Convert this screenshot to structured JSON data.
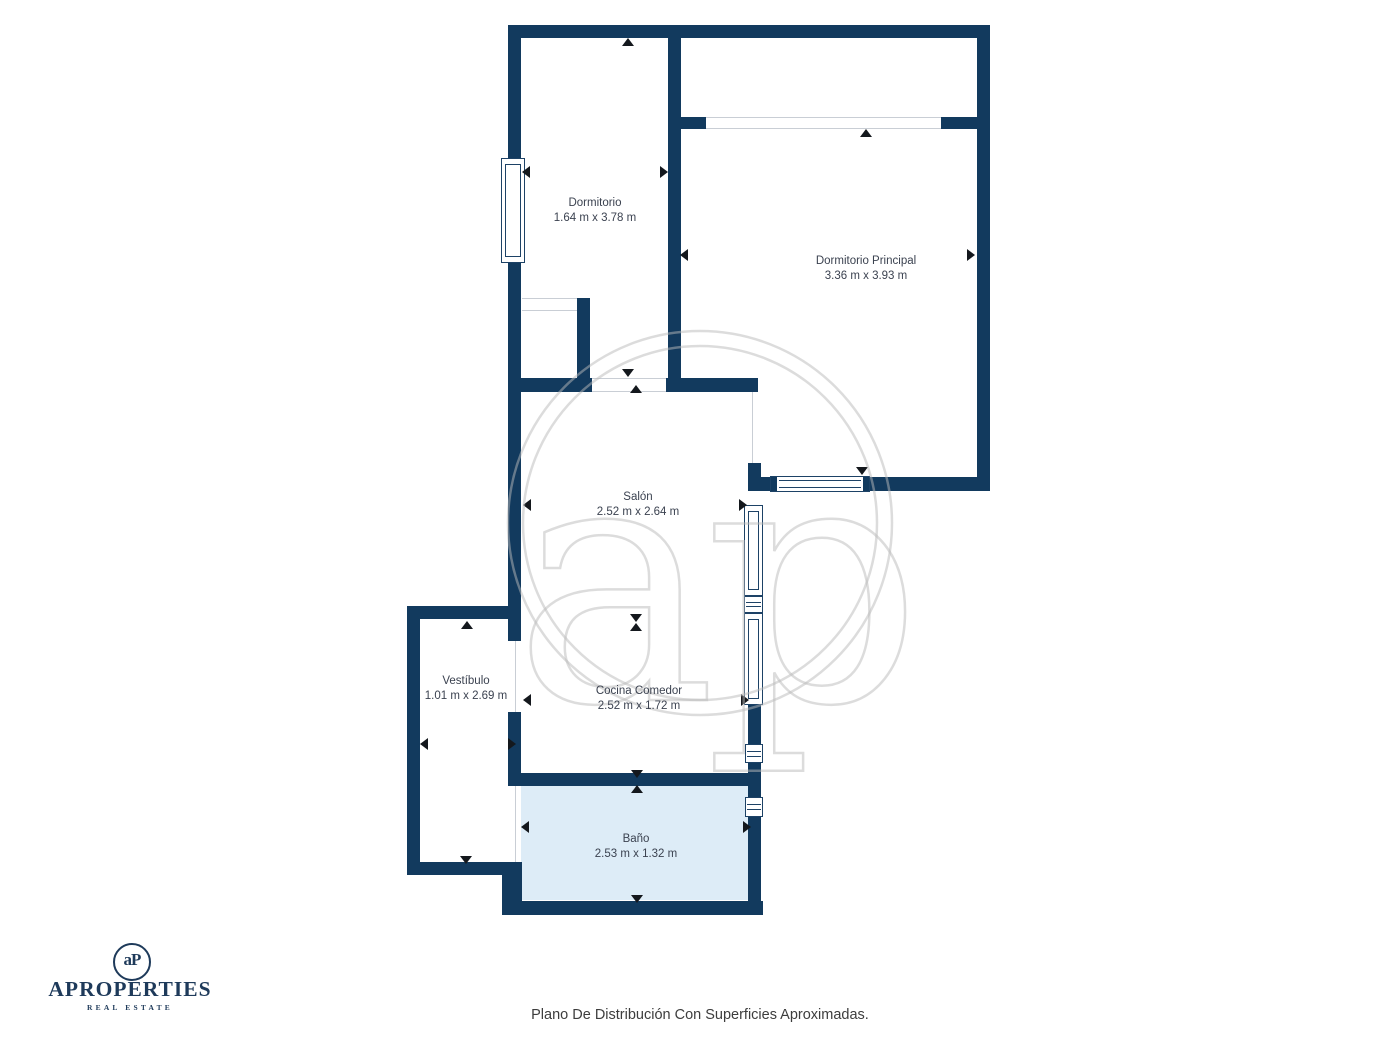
{
  "page": {
    "caption": "Plano De Distribución Con Superficies Aproximadas."
  },
  "branding": {
    "monogram": "aP",
    "name": "APROPERTIES",
    "tagline": "REAL ESTATE"
  },
  "watermark": {
    "letters": "ap"
  },
  "plan": {
    "colors": {
      "wall": "#123a5e",
      "frame": "#1d4266",
      "opening_line": "#c9ced5",
      "bath_fill": "#ddecf7",
      "arrow": "#14181d",
      "label": "#3b4250",
      "watermark": "rgba(185,185,185,0.5)"
    },
    "rooms": [
      {
        "name": "Dormitorio",
        "dims": "1.64 m x 3.78 m",
        "cx": 595,
        "top": 196
      },
      {
        "name": "Dormitorio Principal",
        "dims": "3.36 m x 3.93 m",
        "cx": 866,
        "top": 254
      },
      {
        "name": "Salón",
        "dims": "2.52 m x 2.64 m",
        "cx": 638,
        "top": 490
      },
      {
        "name": "Vestíbulo",
        "dims": "1.01 m x 2.69 m",
        "cx": 466,
        "top": 674
      },
      {
        "name": "Cocina Comedor",
        "dims": "2.52 m x 1.72 m",
        "cx": 639,
        "top": 684
      },
      {
        "name": "Baño",
        "dims": "2.53 m x 1.32 m",
        "cx": 636,
        "top": 832
      }
    ],
    "bath_fill_rect": [
      521,
      786,
      227,
      114
    ],
    "walls": [
      [
        508,
        25,
        482,
        13
      ],
      [
        508,
        38,
        13,
        121
      ],
      [
        508,
        263,
        13,
        129
      ],
      [
        668,
        25,
        13,
        365
      ],
      [
        681,
        117,
        25,
        12
      ],
      [
        941,
        117,
        36,
        12
      ],
      [
        977,
        38,
        13,
        453
      ],
      [
        748,
        463,
        13,
        28
      ],
      [
        748,
        477,
        22,
        14
      ],
      [
        870,
        477,
        120,
        14
      ],
      [
        577,
        298,
        13,
        94
      ],
      [
        508,
        378,
        84,
        14
      ],
      [
        666,
        378,
        92,
        14
      ],
      [
        508,
        392,
        13,
        249
      ],
      [
        508,
        712,
        13,
        74
      ],
      [
        502,
        862,
        20,
        53
      ],
      [
        407,
        606,
        114,
        13
      ],
      [
        407,
        619,
        13,
        256
      ],
      [
        407,
        862,
        95,
        13
      ],
      [
        508,
        773,
        240,
        13
      ],
      [
        748,
        705,
        13,
        39
      ],
      [
        748,
        763,
        13,
        34
      ],
      [
        748,
        817,
        13,
        87
      ],
      [
        509,
        901,
        254,
        14
      ]
    ],
    "openings": [
      [
        706,
        117,
        235,
        12,
        "h"
      ],
      [
        522,
        298,
        55,
        13,
        "h"
      ],
      [
        592,
        378,
        74,
        14,
        "h"
      ],
      [
        745,
        392,
        13,
        71,
        "v"
      ],
      [
        508,
        641,
        13,
        71,
        "v"
      ],
      [
        508,
        786,
        13,
        76,
        "v"
      ]
    ],
    "windows": [
      [
        501,
        158,
        24,
        105,
        "tall-v"
      ],
      [
        770,
        476,
        100,
        16,
        "cap-h"
      ],
      [
        744,
        505,
        19,
        91,
        "tall-v"
      ],
      [
        744,
        596,
        19,
        17,
        "bars"
      ],
      [
        744,
        613,
        19,
        92,
        "tall-v"
      ],
      [
        745,
        744,
        18,
        19,
        "bars"
      ],
      [
        745,
        797,
        18,
        20,
        "bars"
      ]
    ],
    "arrows": [
      [
        628,
        42,
        "up"
      ],
      [
        526,
        172,
        "left"
      ],
      [
        664,
        172,
        "right"
      ],
      [
        628,
        373,
        "down"
      ],
      [
        636,
        389,
        "up"
      ],
      [
        866,
        133,
        "up"
      ],
      [
        684,
        255,
        "left"
      ],
      [
        971,
        255,
        "right"
      ],
      [
        862,
        471,
        "down"
      ],
      [
        527,
        505,
        "left"
      ],
      [
        743,
        505,
        "right"
      ],
      [
        636,
        618,
        "down"
      ],
      [
        636,
        627,
        "up"
      ],
      [
        527,
        700,
        "left"
      ],
      [
        745,
        700,
        "right"
      ],
      [
        637,
        774,
        "down"
      ],
      [
        637,
        789,
        "up"
      ],
      [
        525,
        827,
        "left"
      ],
      [
        747,
        827,
        "right"
      ],
      [
        637,
        899,
        "down"
      ],
      [
        467,
        625,
        "up"
      ],
      [
        466,
        860,
        "down"
      ],
      [
        424,
        744,
        "left"
      ],
      [
        512,
        744,
        "right"
      ]
    ],
    "watermark_geo": {
      "cx": 700,
      "cy": 523,
      "r_outer": 192,
      "r_inner": 177,
      "text_x": 712,
      "text_y": 700,
      "font_size": 340
    }
  }
}
